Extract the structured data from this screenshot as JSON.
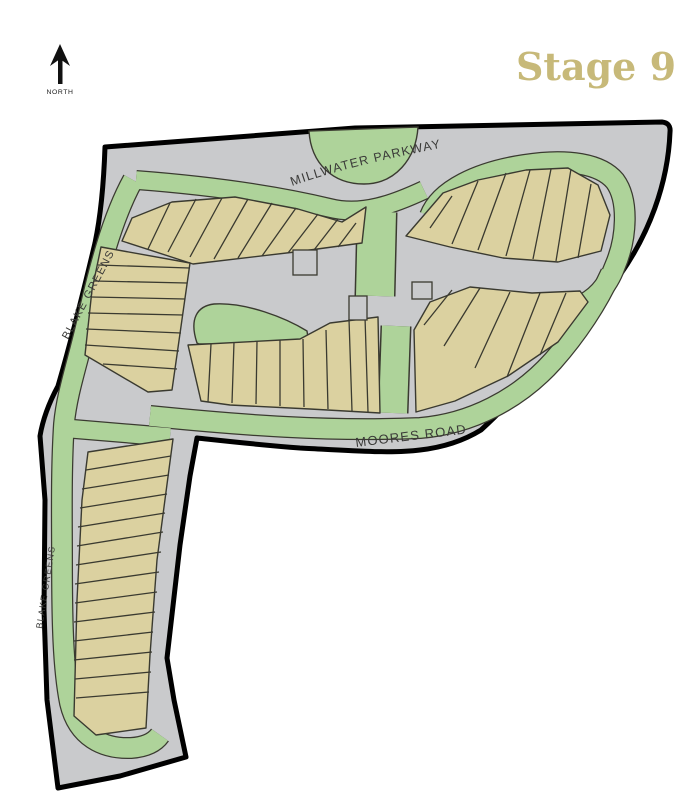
{
  "title": {
    "stage_label": "Stage 9"
  },
  "compass": {
    "label": "NORTH"
  },
  "streets": {
    "millwater": "MILLWATER PARKWAY",
    "moores": "MOORES ROAD",
    "blake_greens_main": "BLAKE GREENS",
    "blake_greens_south": "BLAKE GREENS"
  },
  "colors": {
    "road": "#c9cacc",
    "reserve": "#aed39a",
    "lot": "#dbd1a0",
    "outline": "#3a3a30",
    "boundary": "#000000",
    "stage": "#c7b979",
    "label": "#3a3a38",
    "background": "#ffffff"
  }
}
